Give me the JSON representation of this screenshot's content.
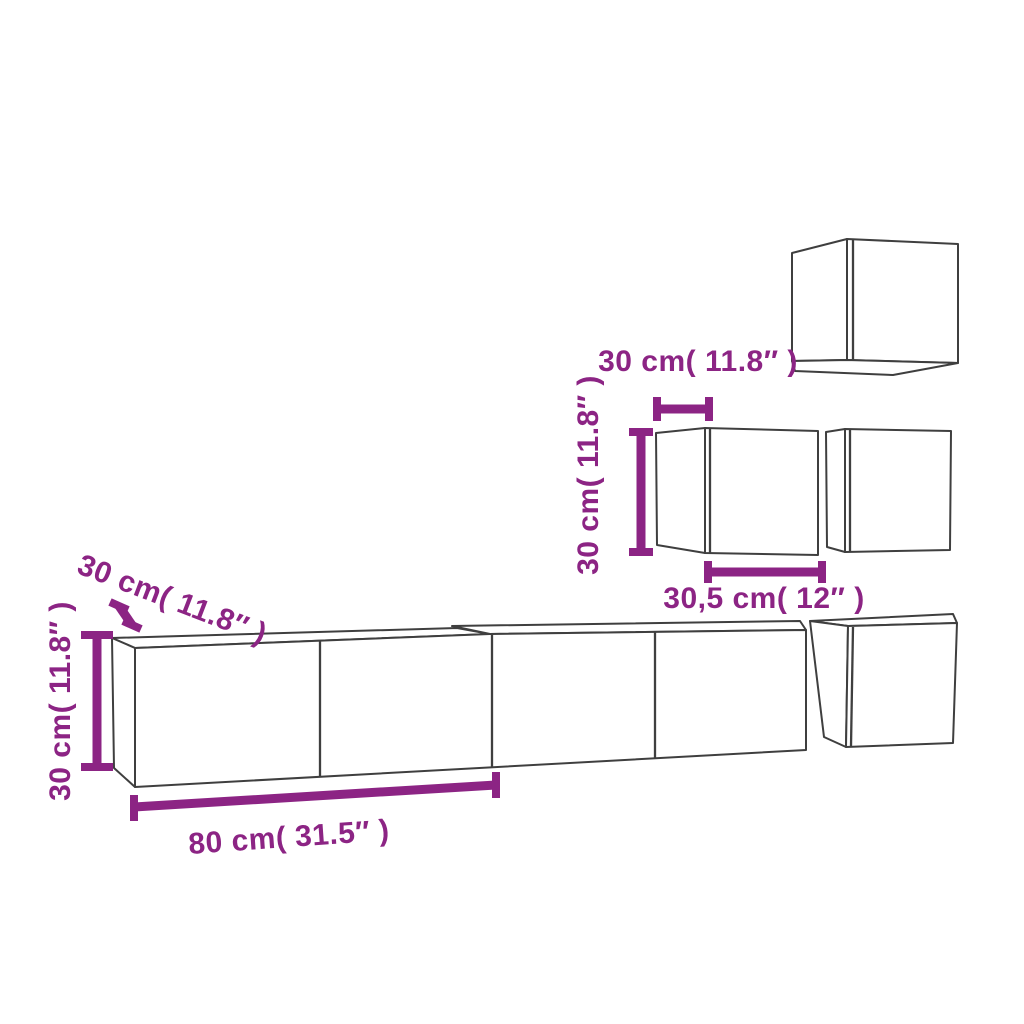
{
  "colors": {
    "dimension_accent": "#8C2484",
    "cabinet_outline": "#3F3F3F",
    "background": "#FFFFFF"
  },
  "dimension_labels": {
    "mid_cabinet_depth": "30 cm( 11.8″ )",
    "mid_cabinet_height": "30 cm( 11.8″ )",
    "mid_cabinet_width": "30,5 cm( 12″ )",
    "long_cabinet_depth": "30 cm( 11.8″ )",
    "long_cabinet_height": "30 cm( 11.8″ )",
    "long_cabinet_width": "80 cm( 31.5″ )"
  }
}
